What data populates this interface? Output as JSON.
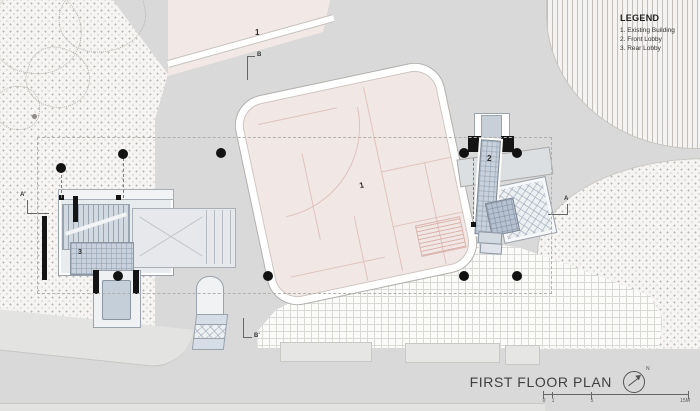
{
  "drawing": {
    "title": "FIRST FLOOR PLAN",
    "north_label": "N",
    "legend": {
      "title": "LEGEND",
      "items": [
        "1. Existing Building",
        "2. Front Lobby",
        "3. Rear Lobby"
      ]
    },
    "labels": {
      "existing_building_main": "1",
      "existing_building_top": "1",
      "front_lobby": "2",
      "rear_lobby": "3"
    },
    "section_markers": {
      "top": "B",
      "bottom": "B'",
      "left": "A'",
      "right": "A"
    },
    "scale": {
      "ticks": [
        "0",
        "1",
        "5",
        "15M"
      ]
    },
    "colors": {
      "road_gray": "#d9d9d9",
      "building_pink": "#f1e7e4",
      "lobby_blue": "#c9d2dc",
      "ink_black": "#141414",
      "dash_line": "#b5b2ae"
    }
  }
}
